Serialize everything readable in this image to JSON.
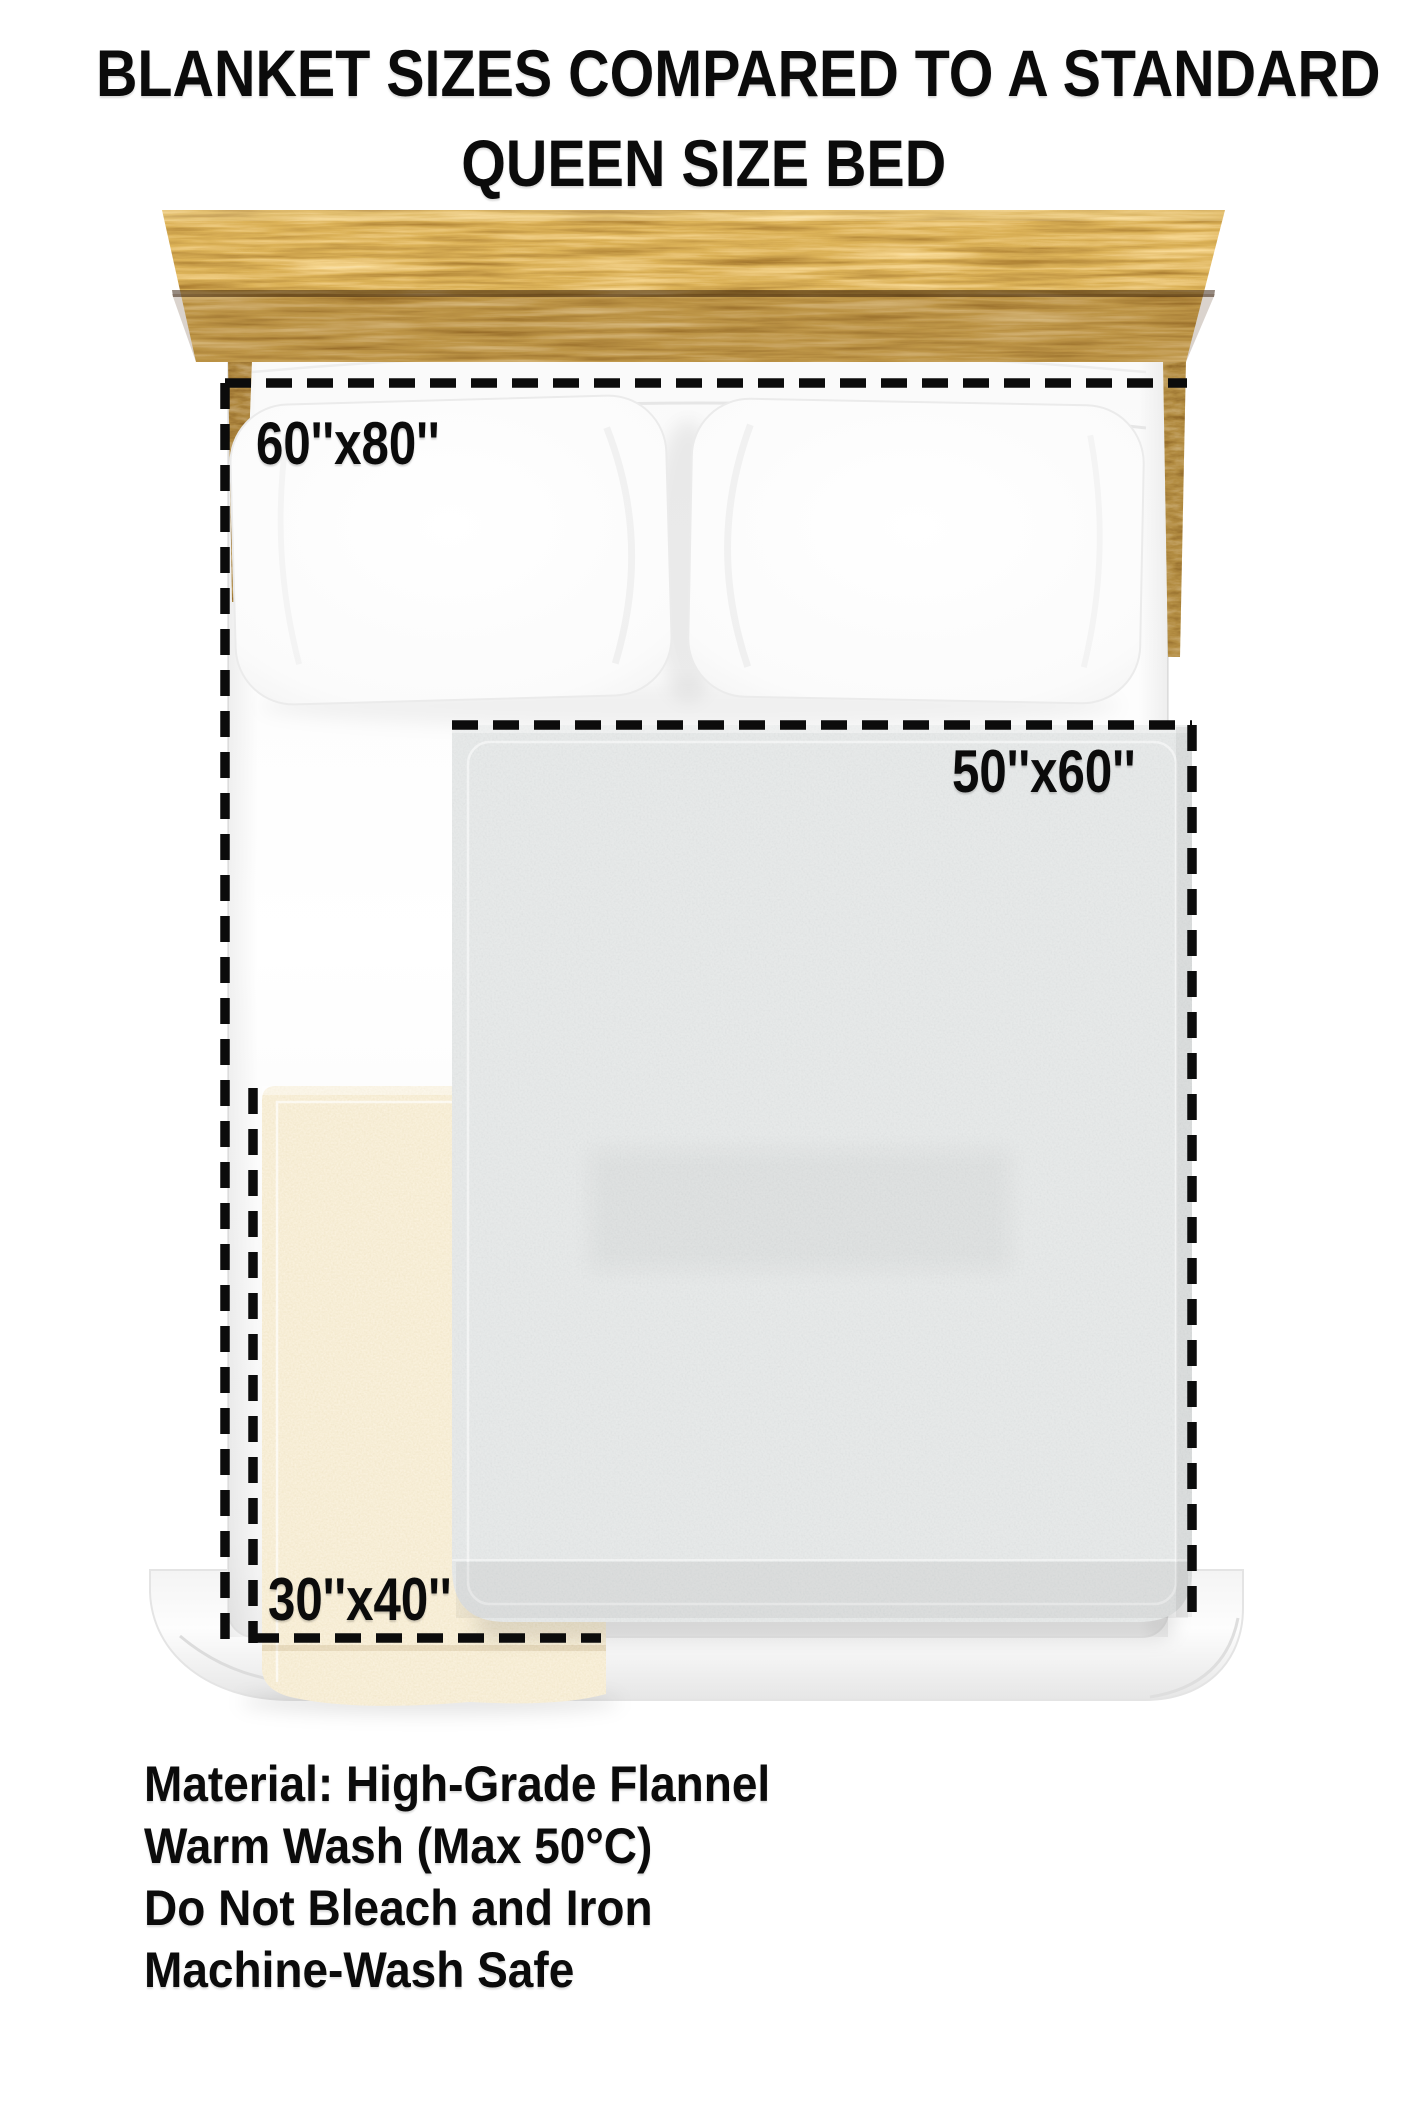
{
  "title": {
    "line1": "BLANKET SIZES COMPARED TO A STANDARD",
    "line2": "QUEEN SIZE BED"
  },
  "size_labels": {
    "blanket_60x80": "60''x80''",
    "blanket_50x60": "50''x60''",
    "blanket_30x40": "30''x40''"
  },
  "care_info": {
    "lines": [
      "Material: High-Grade Flannel",
      "Warm Wash (Max 50°C)",
      "Do Not Bleach and Iron",
      "Machine-Wash Safe"
    ]
  },
  "colors": {
    "text": "#0b0b0b",
    "wood": "#b97a2e",
    "wood_dark": "#6b3c0c",
    "sheet": "#fbfbfb",
    "gray_blanket": "#c4c7c6",
    "cream_blanket": "#ecd9ae",
    "dash_outline": "#0c0c0c"
  }
}
